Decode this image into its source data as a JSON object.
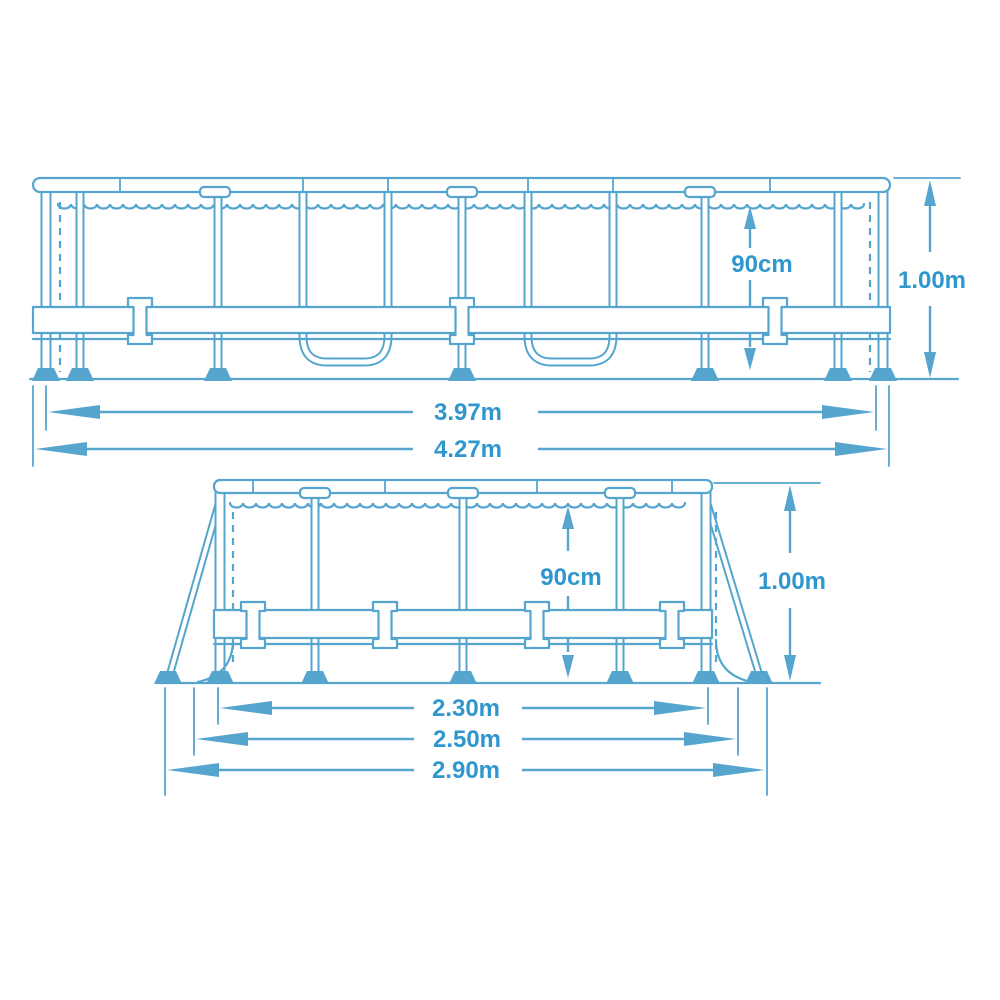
{
  "colors": {
    "line": "#55a5cf",
    "text": "#2f97ce",
    "background": "#ffffff"
  },
  "side_view": {
    "depth": "90cm",
    "height": "1.00m",
    "inner_length": "3.97m",
    "outer_length": "4.27m"
  },
  "end_view": {
    "depth": "90cm",
    "height": "1.00m",
    "inner_width": "2.30m",
    "frame_width": "2.50m",
    "footprint_width": "2.90m"
  }
}
